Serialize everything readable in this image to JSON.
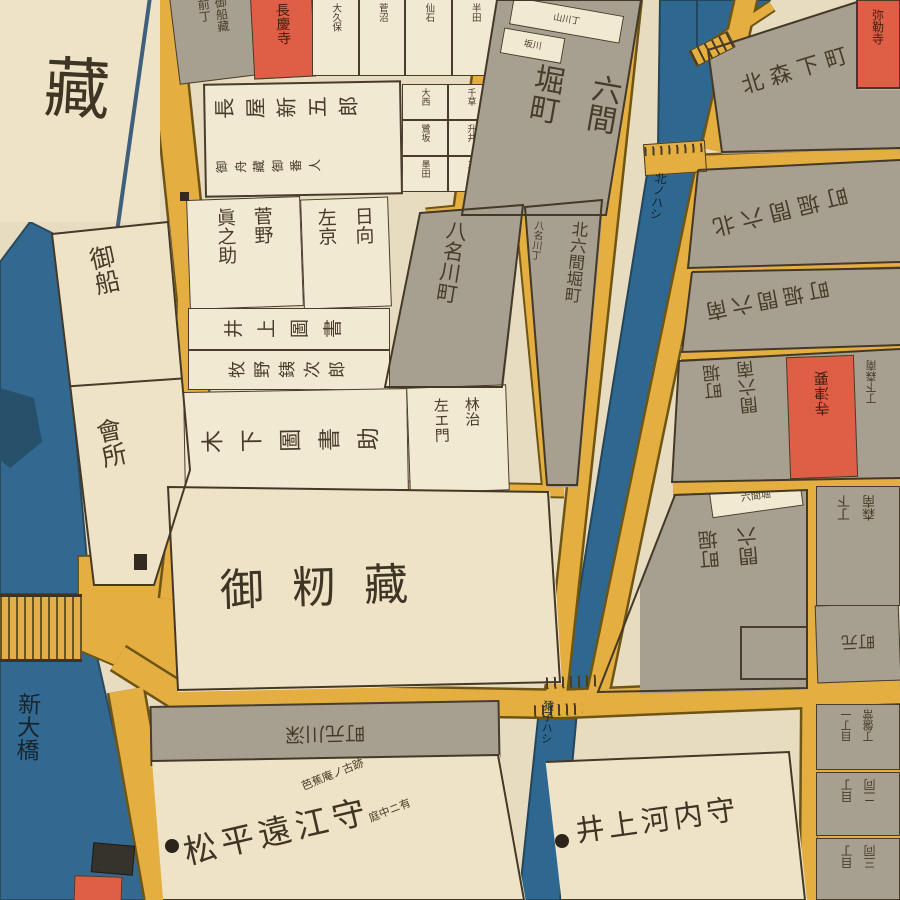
{
  "palette": {
    "paper": "#e8dcc0",
    "block_gray": "#a7a091",
    "block_cream": "#eee3c6",
    "road_yellow": "#e4ae41",
    "water_blue": "#336990",
    "temple_red": "#df5f46",
    "ink": "#483d2b"
  },
  "water": {
    "river_bridge": "新大橋",
    "bridge_north": "北ノハシ",
    "bridge_saruko": "猿子ハシ"
  },
  "b": {
    "kura": "藏",
    "funate": "御船",
    "kaisho": "會所",
    "funagura_mae_r": "御船藏",
    "funagura_mae_l": "前丁",
    "temple_top": "長慶寺",
    "top_names": [
      "大久保",
      "菅沼",
      "仙石",
      "半田"
    ],
    "right_names": [
      "大西",
      "千草",
      "鷺坂",
      "升井",
      "墨田",
      "三井"
    ],
    "nagaya": "長屋新五郎",
    "funaban": "御舟藏御番人",
    "g_tag1": "山川丁",
    "g_tag2": "坂川",
    "rokken_r": "六間",
    "rokken_l": "堀町",
    "yanagawa": "八名川町",
    "strip_small": "八名川丁",
    "strip_main": "北六間堀町",
    "sugano_r": "菅野",
    "sugano_l": "眞之助",
    "hyuga_r": "日向",
    "hyuga_l": "左京",
    "inoue_tosho": "井上圖書",
    "makino": "牧野銕次郎",
    "kinoshita": "木下圖書助",
    "hayashi_r": "林治",
    "hayashi_l": "左エ門",
    "momigura": "御籾藏",
    "motomachi_strip": "深川元町",
    "matsudaira": "松平遠江守",
    "note1": "芭蕉庵ノ古跡",
    "note2": "庭中ニ有",
    "inoue_kawachi": "井上河内守",
    "kita_morishita": "北森下町",
    "mirokuji": "弥勒寺",
    "kita_rokken": "北六間堀町",
    "minami_rokken": "南六間堀町",
    "m_rokken_r": "南六間",
    "m_rokken_l": "堀町",
    "yoshinji": "要津寺",
    "minami_morishita": "南森下丁",
    "p4_tag": "六間堀",
    "p4_r": "六間",
    "p4_l": "堀町",
    "p4r_r": "南森",
    "p4r_l": "下丁",
    "motomachi": "元町",
    "tokiwa_r": "常盤丁",
    "tokiwa_l": "一丁目",
    "do2_r": "同二",
    "do2_l": "丁目",
    "do3_r": "同三",
    "do3_l": "丁目"
  }
}
